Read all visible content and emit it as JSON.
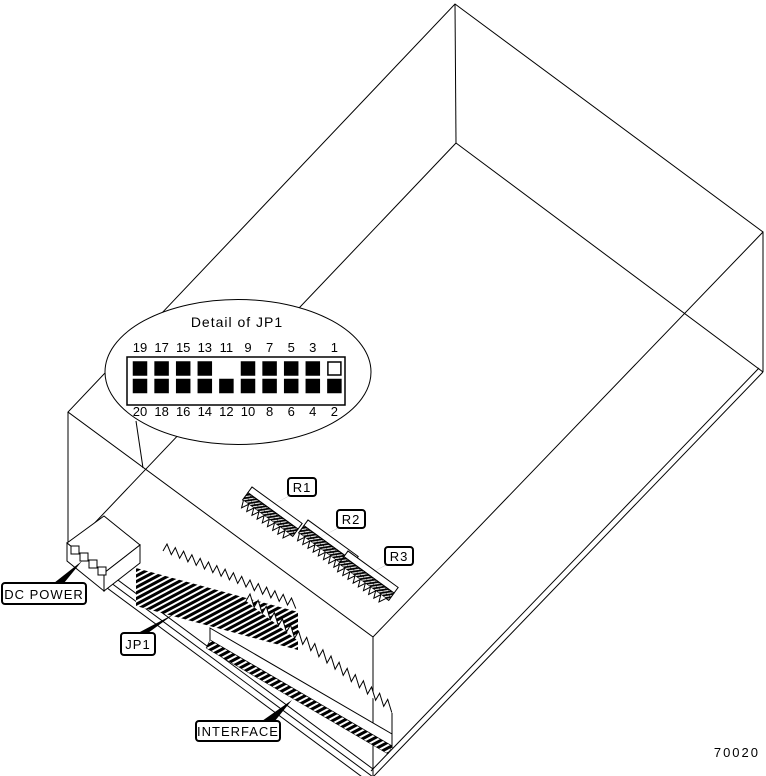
{
  "figure": {
    "number": "70020"
  },
  "detail": {
    "title": "Detail of JP1",
    "pins": {
      "top": [
        {
          "label": "19",
          "state": "filled"
        },
        {
          "label": "17",
          "state": "filled"
        },
        {
          "label": "15",
          "state": "filled"
        },
        {
          "label": "13",
          "state": "filled"
        },
        {
          "label": "11",
          "state": "absent"
        },
        {
          "label": "9",
          "state": "filled"
        },
        {
          "label": "7",
          "state": "filled"
        },
        {
          "label": "5",
          "state": "filled"
        },
        {
          "label": "3",
          "state": "filled"
        },
        {
          "label": "1",
          "state": "open"
        }
      ],
      "bottom": [
        {
          "label": "20",
          "state": "filled"
        },
        {
          "label": "18",
          "state": "filled"
        },
        {
          "label": "16",
          "state": "filled"
        },
        {
          "label": "14",
          "state": "filled"
        },
        {
          "label": "12",
          "state": "filled"
        },
        {
          "label": "10",
          "state": "filled"
        },
        {
          "label": "8",
          "state": "filled"
        },
        {
          "label": "6",
          "state": "filled"
        },
        {
          "label": "4",
          "state": "filled"
        },
        {
          "label": "2",
          "state": "filled"
        }
      ]
    }
  },
  "callouts": {
    "dc_power": "DC POWER",
    "jp1": "JP1",
    "r1": "R1",
    "r2": "R2",
    "r3": "R3",
    "interface": "INTERFACE"
  },
  "colors": {
    "ink": "#000000",
    "paper": "#ffffff"
  }
}
